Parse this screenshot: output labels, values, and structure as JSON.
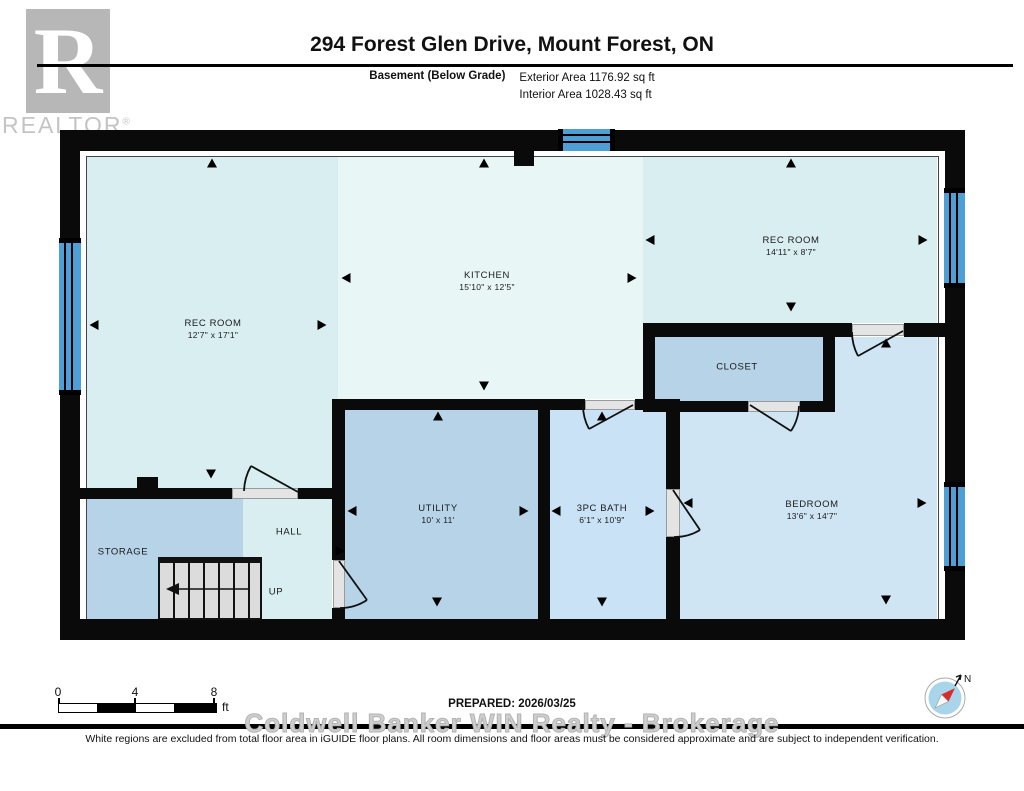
{
  "header": {
    "logo_letter": "R",
    "logo_brand": "REALTOR",
    "logo_registered": "®",
    "title": "294 Forest Glen Drive, Mount Forest, ON",
    "floor_label": "Basement (Below Grade)",
    "exterior_area": "Exterior Area 1176.92 sq ft",
    "interior_area": "Interior Area 1028.43 sq ft"
  },
  "rooms": {
    "rec_left": {
      "label": "REC ROOM",
      "dims": "12'7\" x 17'1\""
    },
    "kitchen": {
      "label": "KITCHEN",
      "dims": "15'10\" x 12'5\""
    },
    "rec_right": {
      "label": "REC ROOM",
      "dims": "14'11\" x 8'7\""
    },
    "closet": {
      "label": "CLOSET"
    },
    "utility": {
      "label": "UTILITY",
      "dims": "10' x 11'"
    },
    "bath": {
      "label": "3PC BATH",
      "dims": "6'1\" x 10'9\""
    },
    "bedroom": {
      "label": "BEDROOM",
      "dims": "13'6\" x 14'7\""
    },
    "storage": {
      "label": "STORAGE"
    },
    "hall": {
      "label": "HALL"
    },
    "stairs": {
      "label": "UP"
    }
  },
  "footer": {
    "scale_0": "0",
    "scale_4": "4",
    "scale_8": "8",
    "scale_unit": "ft",
    "prepared": "PREPARED: 2026/03/25",
    "watermark": "Coldwell Banker WIN Realty - Brokerage",
    "disclaimer": "White regions are excluded from total floor area in iGUIDE floor plans. All room dimensions and floor areas must be considered approximate and are subject to independent verification.",
    "compass_north": "N"
  },
  "colors": {
    "cyan": "#d9eef1",
    "cyanLight": "#e9f6f6",
    "steel": "#b6d3e8",
    "bath": "#c9e2f6",
    "bed": "#cfe5f3",
    "windowBlue": "#4d9fd6",
    "wall": "#0a0a0a",
    "doorGray": "#e4e4e4",
    "stairGray": "#dcdcdc",
    "logoGray": "#b7b7b7",
    "logoTextGray": "#c4c4c4",
    "watermarkGray": "#cecece",
    "compassBlue": "#a9d5ea",
    "compassRed": "#d92b2b"
  }
}
